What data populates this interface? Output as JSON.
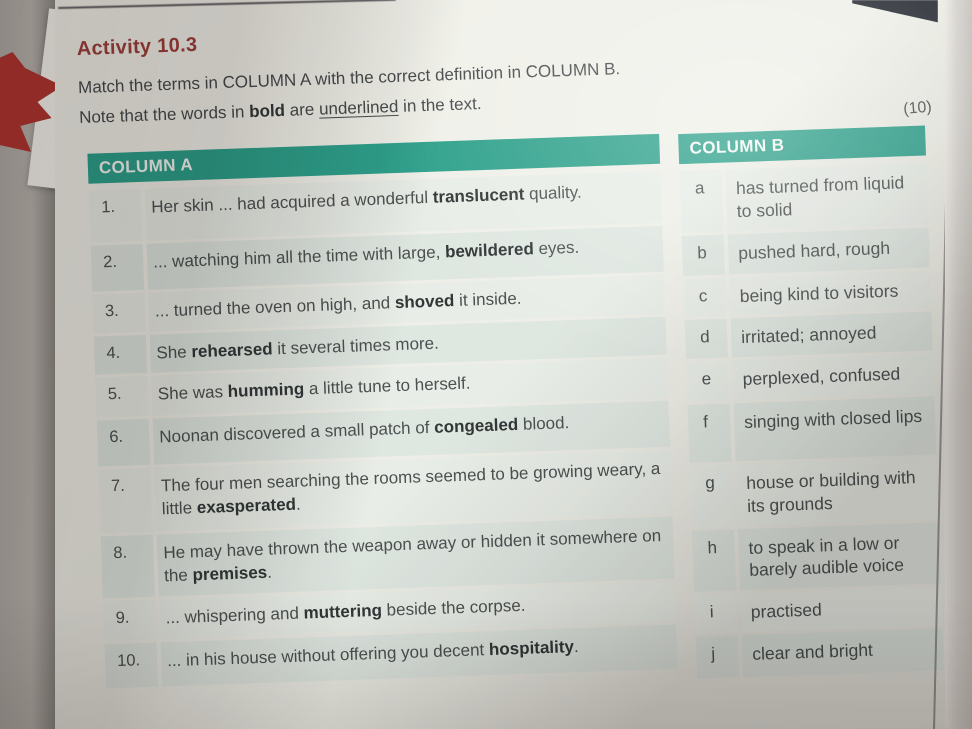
{
  "page": {
    "activity_title": "Activity 10.3",
    "instruction": "Match the terms in COLUMN A with the correct definition in COLUMN B.",
    "note": "Note that the words in **bold** are __underlined__ in the text.",
    "marks": "(10)"
  },
  "column_a": {
    "header": "COLUMN A",
    "rows": [
      {
        "num": "1.",
        "text": "Her skin ... had acquired a wonderful **translucent** quality."
      },
      {
        "num": "2.",
        "text": "... watching him all the time with large, **bewildered** eyes."
      },
      {
        "num": "3.",
        "text": "... turned the oven on high, and **shoved** it inside."
      },
      {
        "num": "4.",
        "text": "She **rehearsed** it several times more."
      },
      {
        "num": "5.",
        "text": "She was **humming** a little tune to herself."
      },
      {
        "num": "6.",
        "text": "Noonan discovered a small patch of **congealed** blood."
      },
      {
        "num": "7.",
        "text": "The four men searching the rooms seemed to be growing weary, a little **exasperated**."
      },
      {
        "num": "8.",
        "text": "He may have thrown the weapon away or hidden it somewhere on the **premises**."
      },
      {
        "num": "9.",
        "text": "... whispering and **muttering** beside the corpse."
      },
      {
        "num": "10.",
        "text": "... in his house without offering you decent **hospitality**."
      }
    ]
  },
  "column_b": {
    "header": "COLUMN B",
    "rows": [
      {
        "letter": "a",
        "text": "has turned from liquid to solid"
      },
      {
        "letter": "b",
        "text": "pushed hard, rough"
      },
      {
        "letter": "c",
        "text": "being kind to visitors"
      },
      {
        "letter": "d",
        "text": "irritated; annoyed"
      },
      {
        "letter": "e",
        "text": "perplexed, confused"
      },
      {
        "letter": "f",
        "text": "singing with closed lips"
      },
      {
        "letter": "g",
        "text": "house or building with its grounds"
      },
      {
        "letter": "h",
        "text": "to speak in a low or barely audible voice"
      },
      {
        "letter": "i",
        "text": "practised"
      },
      {
        "letter": "j",
        "text": "clear and bright"
      }
    ]
  },
  "colors": {
    "teal": "#2ea18c",
    "title_red": "#9f403c"
  }
}
